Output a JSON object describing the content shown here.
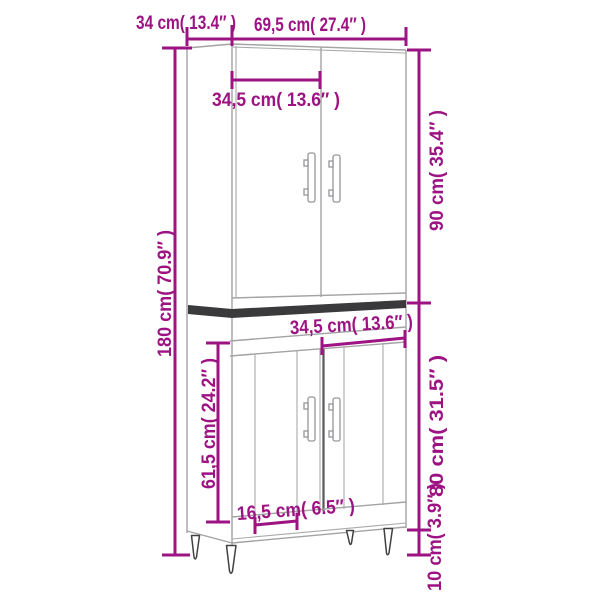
{
  "page": {
    "background": "#ffffff"
  },
  "palette": {
    "accent": "#9E1383",
    "outline_gray": "#A4A2A4",
    "band_dark": "#3A3A3C"
  },
  "product": {
    "type": "highboard cabinet line drawing",
    "sections": [
      "upper two-door cabinet",
      "dark divider band",
      "lower fluted two-door cabinet",
      "four tapered legs"
    ]
  },
  "dimensions": {
    "depth": {
      "cm": "34",
      "in": "13.4",
      "label": "34 cm( 13.4″ )"
    },
    "width": {
      "cm": "69,5",
      "in": "27.4",
      "label": "69,5 cm( 27.4″ )"
    },
    "upper_door_width": {
      "cm": "34,5",
      "in": "13.6",
      "label": "34,5 cm( 13.6″ )"
    },
    "upper_section_height": {
      "cm": "90",
      "in": "35.4",
      "label": "90 cm( 35.4″ )"
    },
    "total_height": {
      "cm": "180",
      "in": "70.9",
      "label": "180 cm( 70.9″ )"
    },
    "lower_door_width": {
      "cm": "34,5",
      "in": "13.6",
      "label": "34,5 cm( 13.6″ )"
    },
    "lower_door_height": {
      "cm": "61,5",
      "in": "24.2",
      "label": "61,5 cm( 24.2″ )"
    },
    "lower_section_height": {
      "cm": "80",
      "in": "31.5",
      "label": "80 cm( 31.5″ )"
    },
    "door_panel_width": {
      "cm": "16,5",
      "in": "6.5",
      "label": "16,5 cm( 6.5″ )"
    },
    "leg_height": {
      "cm": "10",
      "in": "3.9",
      "label": "10 cm( 3.9″ )"
    }
  }
}
